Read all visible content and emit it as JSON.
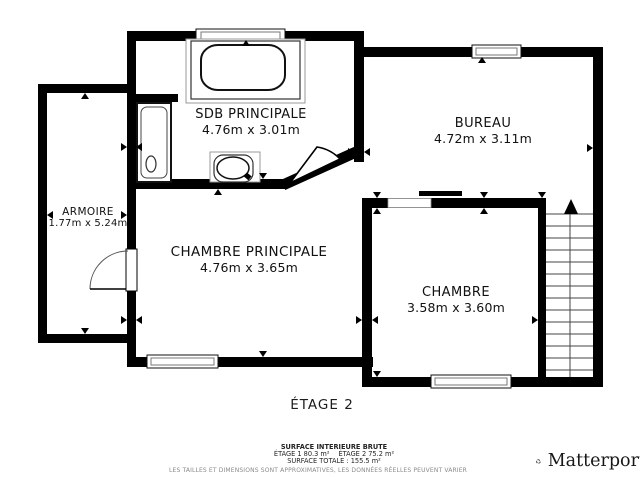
{
  "floor_title": "ÉTAGE 2",
  "rooms": {
    "sdb": {
      "name": "SDB PRINCIPALE",
      "dims": "4.76m x 3.01m"
    },
    "bureau": {
      "name": "BUREAU",
      "dims": "4.72m x 3.11m"
    },
    "armoire": {
      "name": "ARMOIRE",
      "dims": "1.77m x 5.24m"
    },
    "chambre_principale": {
      "name": "CHAMBRE PRINCIPALE",
      "dims": "4.76m x 3.65m"
    },
    "chambre": {
      "name": "CHAMBRE",
      "dims": "3.58m x 3.60m"
    }
  },
  "footer": {
    "surface_heading": "SURFACE INTERIEURE BRUTE",
    "etage1_area": "ÉTAGE 1 80.3 m²",
    "etage2_area": "ÉTAGE 2 75.2 m²",
    "surface_total": "SURFACE TOTALE :  155.5 m²",
    "disclaimer": "LES TAILLES ET DIMENSIONS SONT APPROXIMATIVES, LES DONNÉES RÉELLES PEUVENT VARIER"
  },
  "branding": {
    "logo_text": "Matterport"
  },
  "colors": {
    "wall": "#000000",
    "background": "#ffffff"
  }
}
